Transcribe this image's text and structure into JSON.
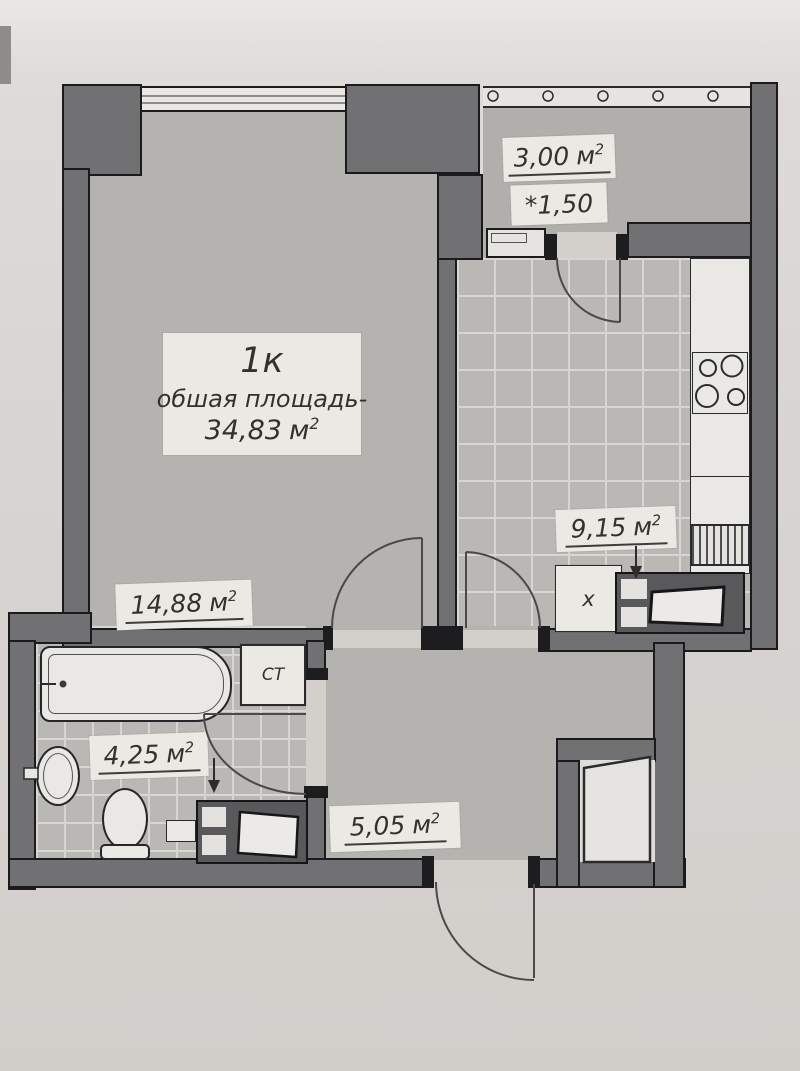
{
  "plan": {
    "unit_sup": "2",
    "living": {
      "name": "1к",
      "subtitle": "обшая площадь-",
      "total_area": "34,83",
      "unit": "м",
      "area": "14,88"
    },
    "balcony": {
      "area": "3,00",
      "unit": "м",
      "coefficient": "*1,50"
    },
    "kitchen": {
      "area": "9,15",
      "unit": "м"
    },
    "bathroom": {
      "area": "4,25",
      "unit": "м"
    },
    "hallway": {
      "area": "5,05",
      "unit": "м"
    },
    "fixtures": {
      "washing_machine": "СТ",
      "fridge": "x"
    }
  },
  "colors": {
    "paper": "#d7d4d1",
    "wall": "#717173",
    "wall_line": "#1b1b1d",
    "cap": "#1d1d20",
    "floor": "#b5b3b0",
    "floor_balcony": "#b1afac",
    "tile": "#bab8b5",
    "tile_line": "#d8d6d2",
    "fixture": "#eae8e4",
    "label_bg": "#ebe9e4",
    "ink": "#33312d",
    "line": "#4a4947"
  }
}
